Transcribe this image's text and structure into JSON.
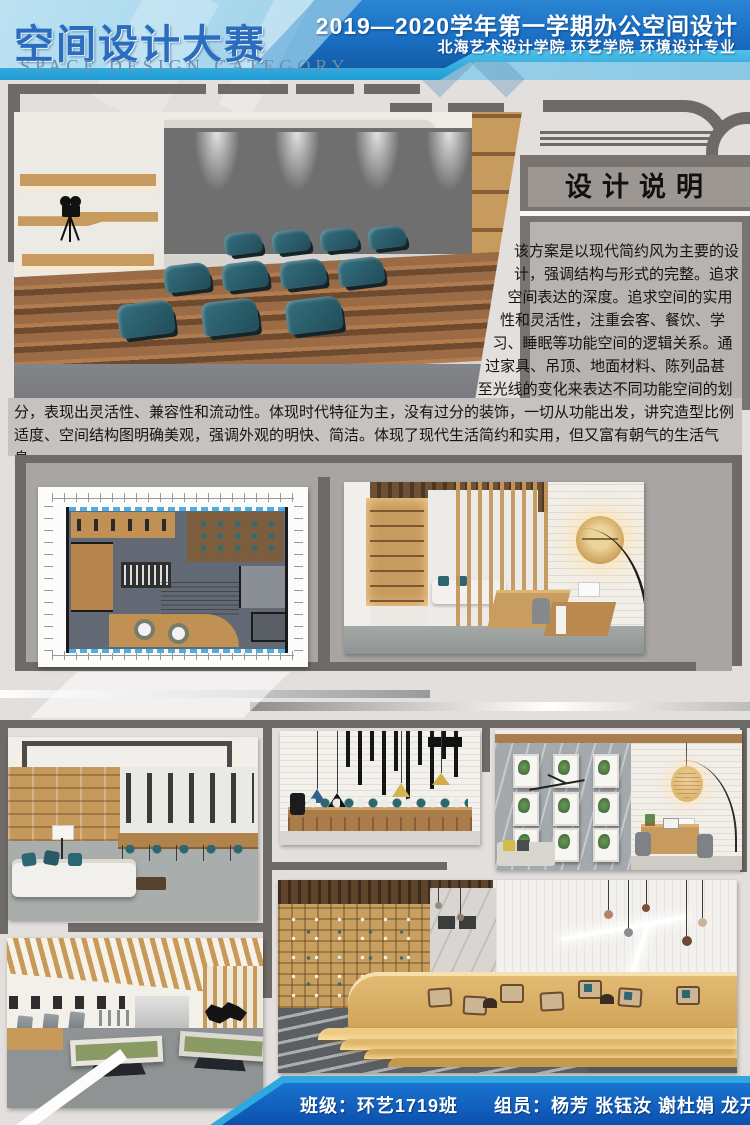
{
  "header": {
    "title_cn": "空间设计大赛",
    "title_en": "SPACE DESIGN CATEGORY",
    "course_line": "2019—2020学年第一学期办公空间设计",
    "school_line": "北海艺术设计学院 环艺学院 环境设计专业"
  },
  "design_note": {
    "title": "设计说明",
    "body": "该方案是以现代简约风为主要的设计，强调结构与形式的完整。追求空间表达的深度。追求空间的实用性和灵活性，注重会客、餐饮、学习、睡眠等功能空间的逻辑关系。通过家具、吊顶、地面材料、陈列品甚至光线的变化来表达不同功能空间的划分，表现出灵活性、兼容性和流动性。体现时代特征为主，没有过分的装饰，一切从功能出发，讲究造型比例适度、空间结构图明确美观，强调外观的明快、简洁。体现了现代生活简约和实用，但又富有朝气的生活气息。"
  },
  "footer": {
    "class_label": "班级：环艺1719班",
    "members_label": "组员：杨芳 张钰汝 谢杜娟 龙开鸾 王雨欣"
  },
  "palette": {
    "header_dark_blue": "#1b6fc4",
    "header_light_blue": "#a7d7ec",
    "cyan_stripe": "#33aede",
    "footer_blue": "#1161c8",
    "accent_teal": "#2d6673",
    "wood": "#c79a5e",
    "frame_gray": "#6e6a67",
    "panel_gray": "#b7b3b0"
  }
}
